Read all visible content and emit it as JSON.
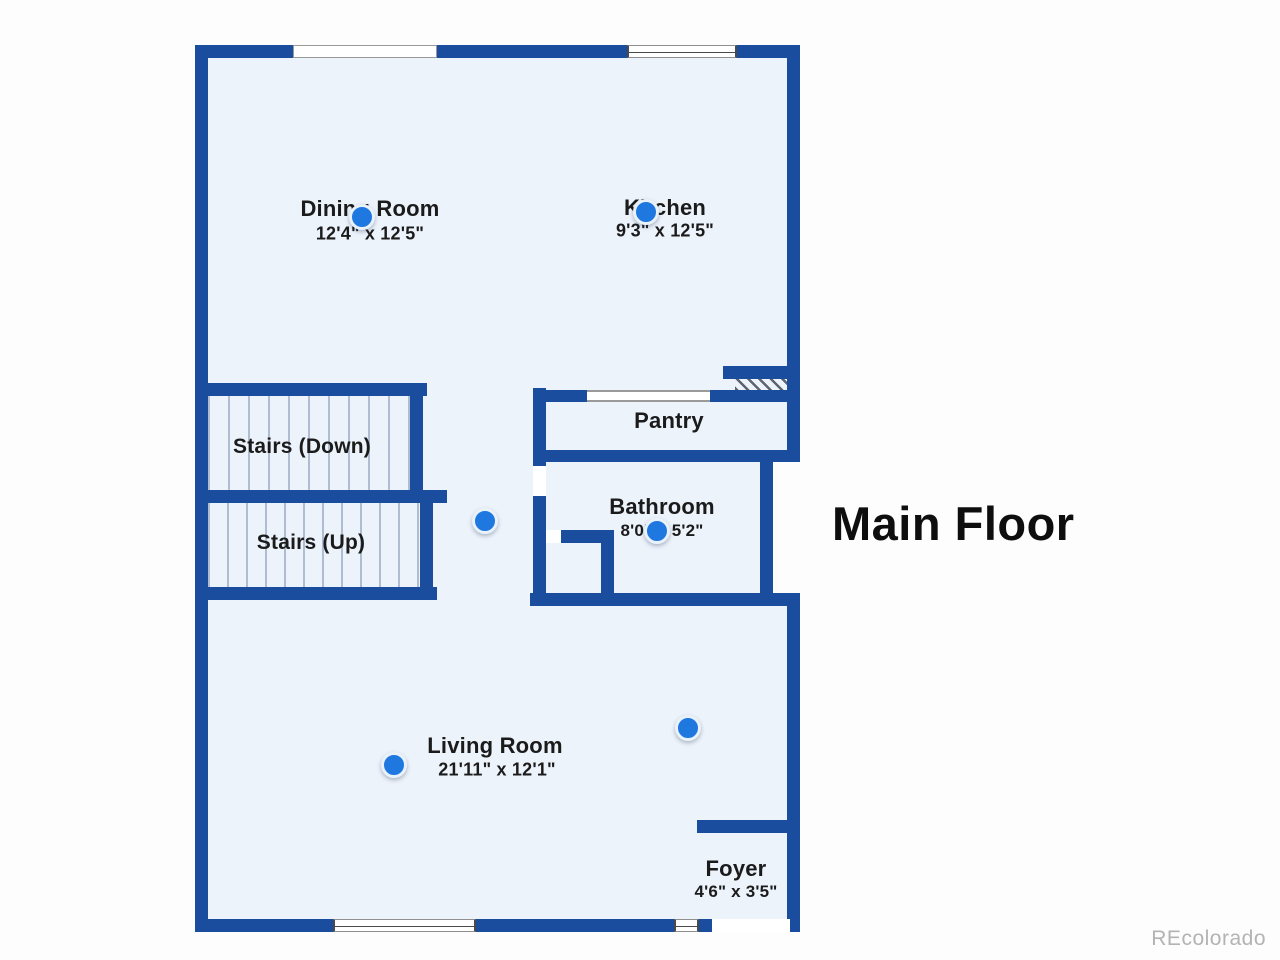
{
  "title": "Main Floor",
  "watermark": "REcolorado",
  "colors": {
    "wall": "#1b4d9e",
    "floor": "#edf3fb",
    "marker": "#1e78e0"
  },
  "rooms": {
    "dining": {
      "name": "Dining Room",
      "dims": "12'4\" x 12'5\""
    },
    "kitchen": {
      "name": "Kitchen",
      "dims": "9'3\" x 12'5\""
    },
    "stairs_down": {
      "name": "Stairs (Down)"
    },
    "stairs_up": {
      "name": "Stairs (Up)"
    },
    "pantry": {
      "name": "Pantry"
    },
    "bathroom": {
      "name": "Bathroom",
      "dims": "8'0\" x 5'2\""
    },
    "living": {
      "name": "Living Room",
      "dims": "21'11\" x 12'1\""
    },
    "foyer": {
      "name": "Foyer",
      "dims": "4'6\" x 3'5\""
    }
  },
  "markers": {
    "count": 6,
    "description": "photo viewpoint markers"
  }
}
